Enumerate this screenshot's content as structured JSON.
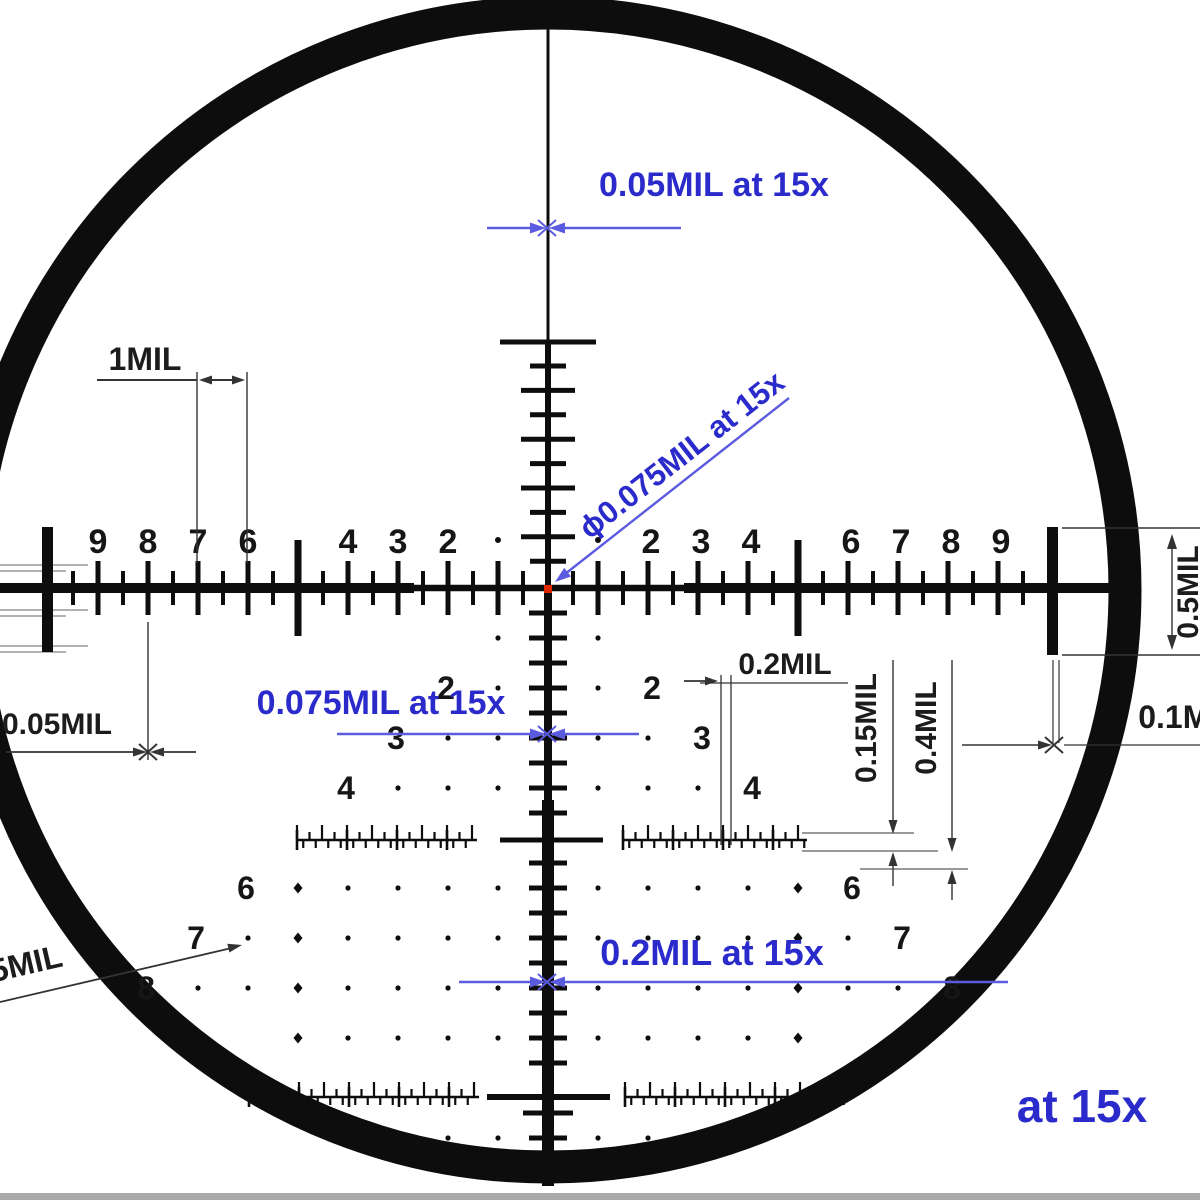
{
  "diagram": {
    "type": "riflescope-reticle-subtension-diagram",
    "magnification_note": "at 15x",
    "colors": {
      "annotation_blue_text": "#2b2bcc",
      "annotation_blue_line": "#5b5be0",
      "reticle_black": "#0d0d0d",
      "dimension_gray": "#555555",
      "center_dot_red": "#e02800",
      "bottom_bar_gray": "#a9a9a9"
    }
  },
  "texts": {
    "top_dim": "0.05MIL at 15x",
    "diag_dim": "ϕ0.075MIL at 15x",
    "mid_dim": "0.075MIL at 15x",
    "bottom_dim": "0.2MIL at 15x",
    "magnification": "at 15x",
    "one_mil": "1MIL",
    "left_small_dim": "0.05MIL",
    "gap_dim": "0.2MIL",
    "ruler_height_dim": "0.15MIL",
    "ruler_height_dim2": "0.4MIL",
    "right_bar_dim": "0.5MIL",
    "right_gap_dim": "0.1MIL",
    "dot_size_dim": "0.25MIL"
  },
  "scale": {
    "upper_left_numbers": [
      "9",
      "8",
      "7",
      "6",
      "4",
      "3",
      "2"
    ],
    "upper_left_mils": [
      9,
      8,
      7,
      6,
      4,
      3,
      2
    ],
    "upper_right_numbers": [
      "2",
      "3",
      "4",
      "6",
      "7",
      "8",
      "9"
    ],
    "upper_right_mils": [
      2,
      3,
      4,
      6,
      7,
      8,
      9
    ],
    "tree_numbers": [
      "2",
      "3",
      "4",
      "6",
      "7",
      "8"
    ],
    "tree_mils": [
      2,
      3,
      4,
      6,
      7,
      8
    ],
    "mil_spacing_px": 50
  },
  "dot_grid": {
    "rows_mil_below_center": [
      1,
      2,
      3,
      4,
      6,
      7,
      8,
      9,
      11
    ],
    "dots_by_row": {
      "1": [
        1
      ],
      "2": [
        1
      ],
      "3": [
        1,
        2
      ],
      "4": [
        1,
        2,
        3
      ],
      "6": [
        1,
        2,
        3,
        4
      ],
      "7": [
        1,
        2,
        3,
        4,
        6
      ],
      "8": [
        1,
        2,
        3,
        4,
        6,
        7
      ],
      "9": [
        1,
        2,
        3,
        4
      ],
      "11": [
        1,
        2,
        3
      ]
    },
    "diamond_cols_by_row": {
      "6": [
        5
      ],
      "7": [
        5
      ],
      "8": [
        5
      ],
      "9": [
        5
      ]
    }
  }
}
